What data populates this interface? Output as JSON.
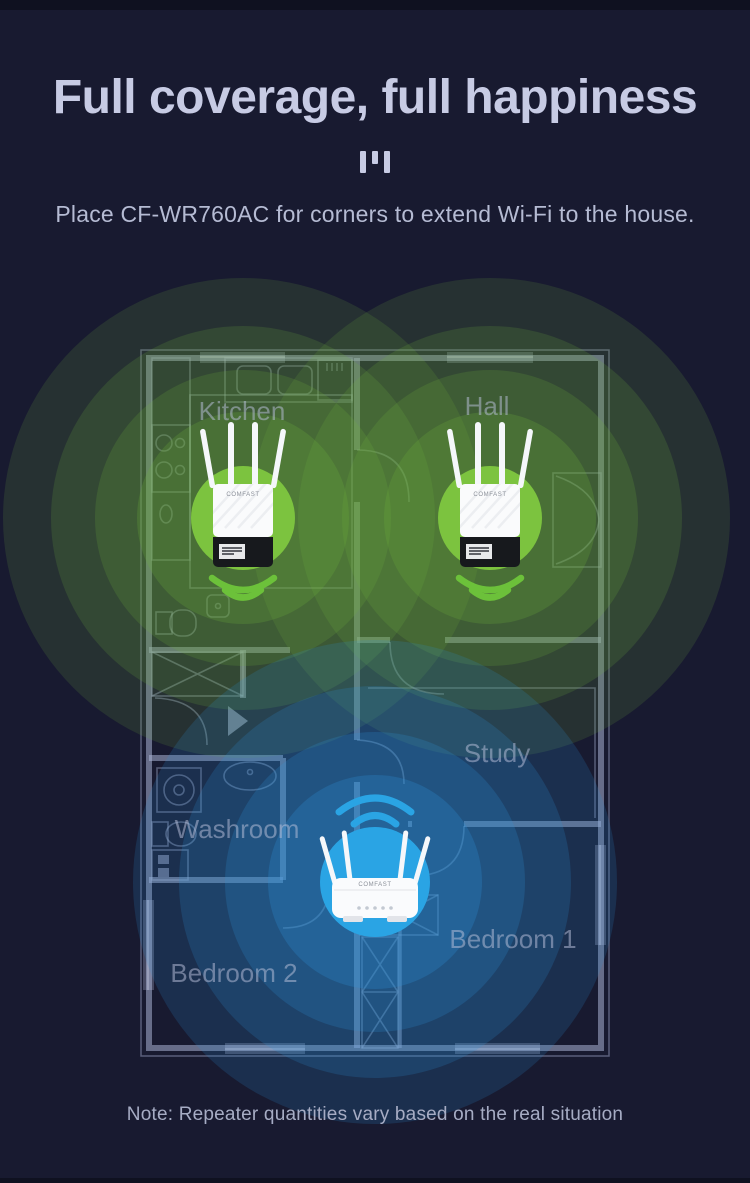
{
  "page": {
    "title": "Full coverage, full happiness",
    "subtitle": "Place CF-WR760AC for corners to extend Wi-Fi to the house.",
    "note": "Note: Repeater quantities vary based on the real situation",
    "background": "#181a30"
  },
  "theme": {
    "accent_green": "#7cc33f",
    "accent_blue": "#2aa4e4",
    "wall_line": "#aab2d4",
    "title_color": "#c7cbe4",
    "subtitle_color": "#b5bbd3",
    "note_color": "#a6acc4",
    "room_label_color": "#b9c0da"
  },
  "floor_plan": {
    "rooms": [
      {
        "name": "Kitchen"
      },
      {
        "name": "Hall"
      },
      {
        "name": "Study"
      },
      {
        "name": "Washroom"
      },
      {
        "name": "Bedroom 1"
      },
      {
        "name": "Bedroom 2"
      }
    ]
  },
  "devices": [
    {
      "id": "repeater-kitchen",
      "type": "wifi-extender",
      "brand": "COMFAST"
    },
    {
      "id": "repeater-hall",
      "type": "wifi-extender",
      "brand": "COMFAST"
    },
    {
      "id": "main-router",
      "type": "router",
      "brand": "COMFAST"
    }
  ]
}
